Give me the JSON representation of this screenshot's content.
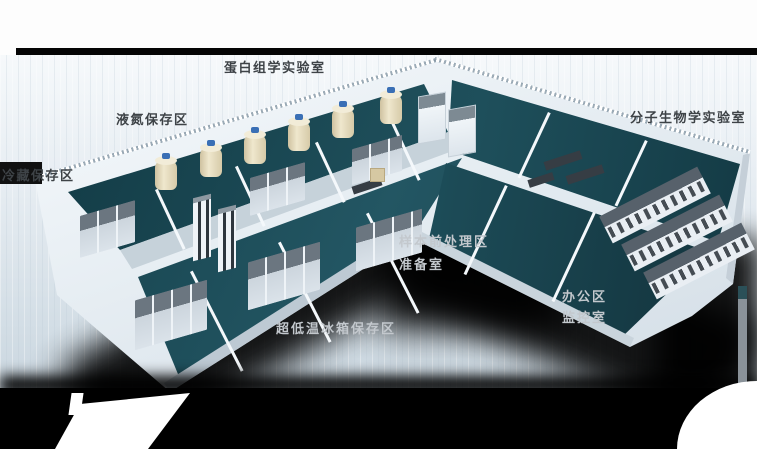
{
  "floorplan": {
    "labels": {
      "proteomics_lab": "蛋白组学实验室",
      "liquid_nitrogen_area": "液氮保存区",
      "cold_storage_area": "冷藏保存区",
      "molecular_biology_lab": "分子生物学实验室",
      "sample_pretreatment_area": "样本前处理区",
      "preparation_room": "准备室",
      "office_area": "办公区",
      "monitoring_room": "监控室",
      "ult_freezer_storage_area": "超低温冰箱保存区"
    },
    "colors": {
      "floor_teal": "#1d4d59",
      "wall_white": "#e9eff5",
      "background_light": "#dfe7ee",
      "divider_bar": "#000000",
      "label_dark": "#3e4347",
      "label_light": "#c3c8cd",
      "tank_body": "#eae1c6",
      "tank_cap": "#3a6fb5"
    }
  }
}
